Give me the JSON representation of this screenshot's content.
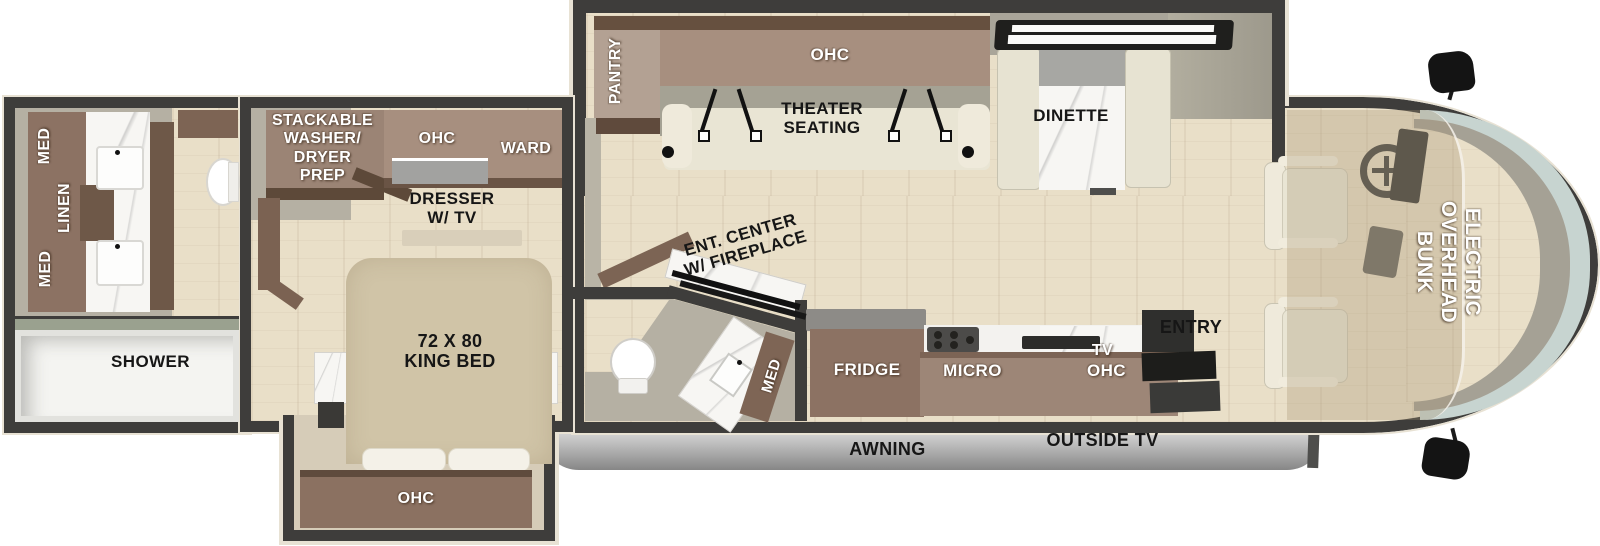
{
  "labels": {
    "rear_bath": {
      "med_upper": "MED",
      "linen": "LINEN",
      "med_lower": "MED",
      "shower": "SHOWER"
    },
    "bedroom": {
      "washer_prep": "STACKABLE\nWASHER/\nDRYER\nPREP",
      "ohc": "OHC",
      "ward": "WARD",
      "dresser": "DRESSER\nW/ TV",
      "king_bed": "72 X 80\nKING BED",
      "bed_ohc": "OHC"
    },
    "living": {
      "pantry": "PANTRY",
      "ohc": "OHC",
      "theater": "THEATER\nSEATING",
      "dinette": "DINETTE",
      "ent_center": "ENT. CENTER\nW/ FIREPLACE"
    },
    "half_bath": {
      "med": "MED"
    },
    "kitchen": {
      "fridge": "FRIDGE",
      "micro": "MICRO",
      "tv": "TV",
      "ohc": "OHC",
      "entry": "ENTRY"
    },
    "cab": {
      "overhead_bunk": "ELECTRIC\nOVERHEAD\nBUNK"
    },
    "exterior": {
      "awning": "AWNING",
      "outside_tv": "OUTSIDE TV"
    }
  },
  "colors": {
    "wall": "#3e3d3b",
    "trim": "#e8e2d4",
    "floor": "#e9dfc8",
    "greige": "#b5b0a3",
    "cabdark": "#6e5848",
    "cabmid": "#8c7263",
    "cablight": "#a78f7f",
    "bed": "#d0c4a7",
    "cushion": "#e9e5d4",
    "marble": "#f7f6f3",
    "awnlight": "#e0e0e0",
    "awndark": "#8f8f8f",
    "glass": "#c7d4d0",
    "black": "#1d1d1b",
    "white": "#ffffff"
  }
}
